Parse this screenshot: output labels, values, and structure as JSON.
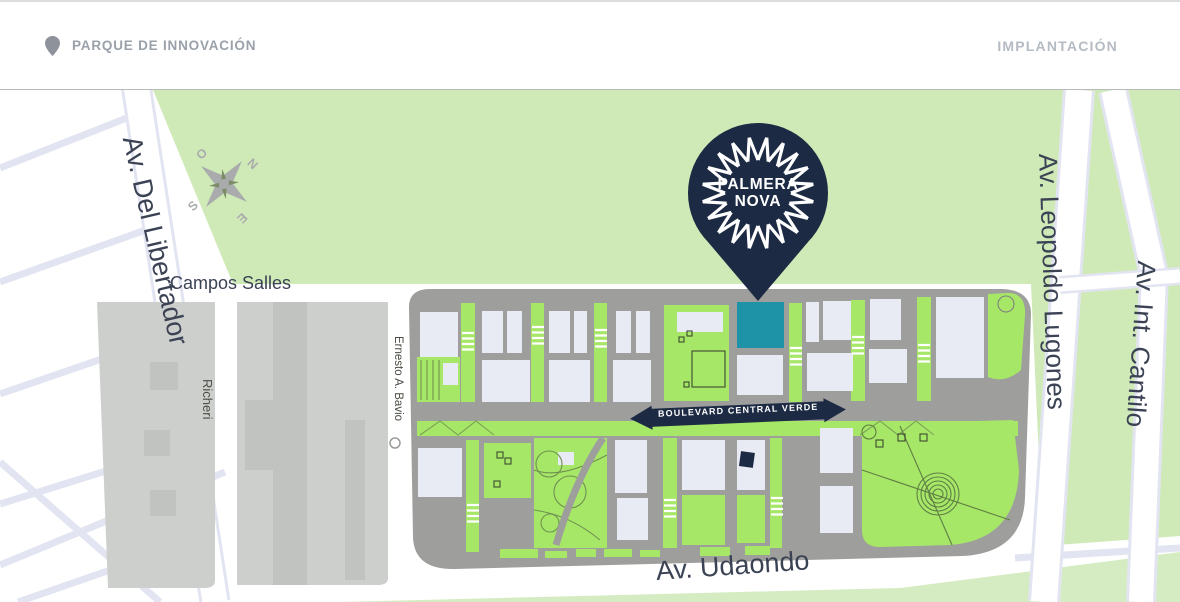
{
  "header": {
    "title": "PARQUE DE INNOVACIÓN",
    "right_label": "IMPLANTACIÓN"
  },
  "pin": {
    "line1": "PALMERA",
    "line2": "NOVA"
  },
  "compass": {
    "o": "O",
    "n": "N",
    "s": "S",
    "e": "E"
  },
  "streets": {
    "libertador": "Av. Del Libertador",
    "campos_salles": "Campos Salles",
    "richeri": "Richeri",
    "bavio": "Ernesto A. Bavio",
    "lugones": "Av. Leopoldo Lugones",
    "cantilo": "Av. Int. Cantilo",
    "udaondo": "Av. Udaondo",
    "boulevard": "BOULEVARD CENTRAL VERDE"
  },
  "icons": {
    "header_pin": "location-pin-icon",
    "compass": "compass-rose-icon",
    "marker": "map-marker-icon",
    "boulevard": "double-arrow-icon"
  },
  "colors": {
    "navy": "#1c2a43",
    "teal": "#1e93a8",
    "park_green": "#cfe9b7",
    "block_green": "#a6e768",
    "map_gray": "#9e9e9c",
    "parcel_gray": "#cdcfcd",
    "parcel_dark": "#c1c3c1",
    "building": "#e8eaf4",
    "road_lavender": "#e2e5f1",
    "label_navy": "#3a4254",
    "header_gray": "#9aa1aa",
    "header_light": "#b5bbc3",
    "icon_gray": "#8d929b",
    "compass_gray": "#a9abad",
    "path_green": "#6f9150"
  }
}
